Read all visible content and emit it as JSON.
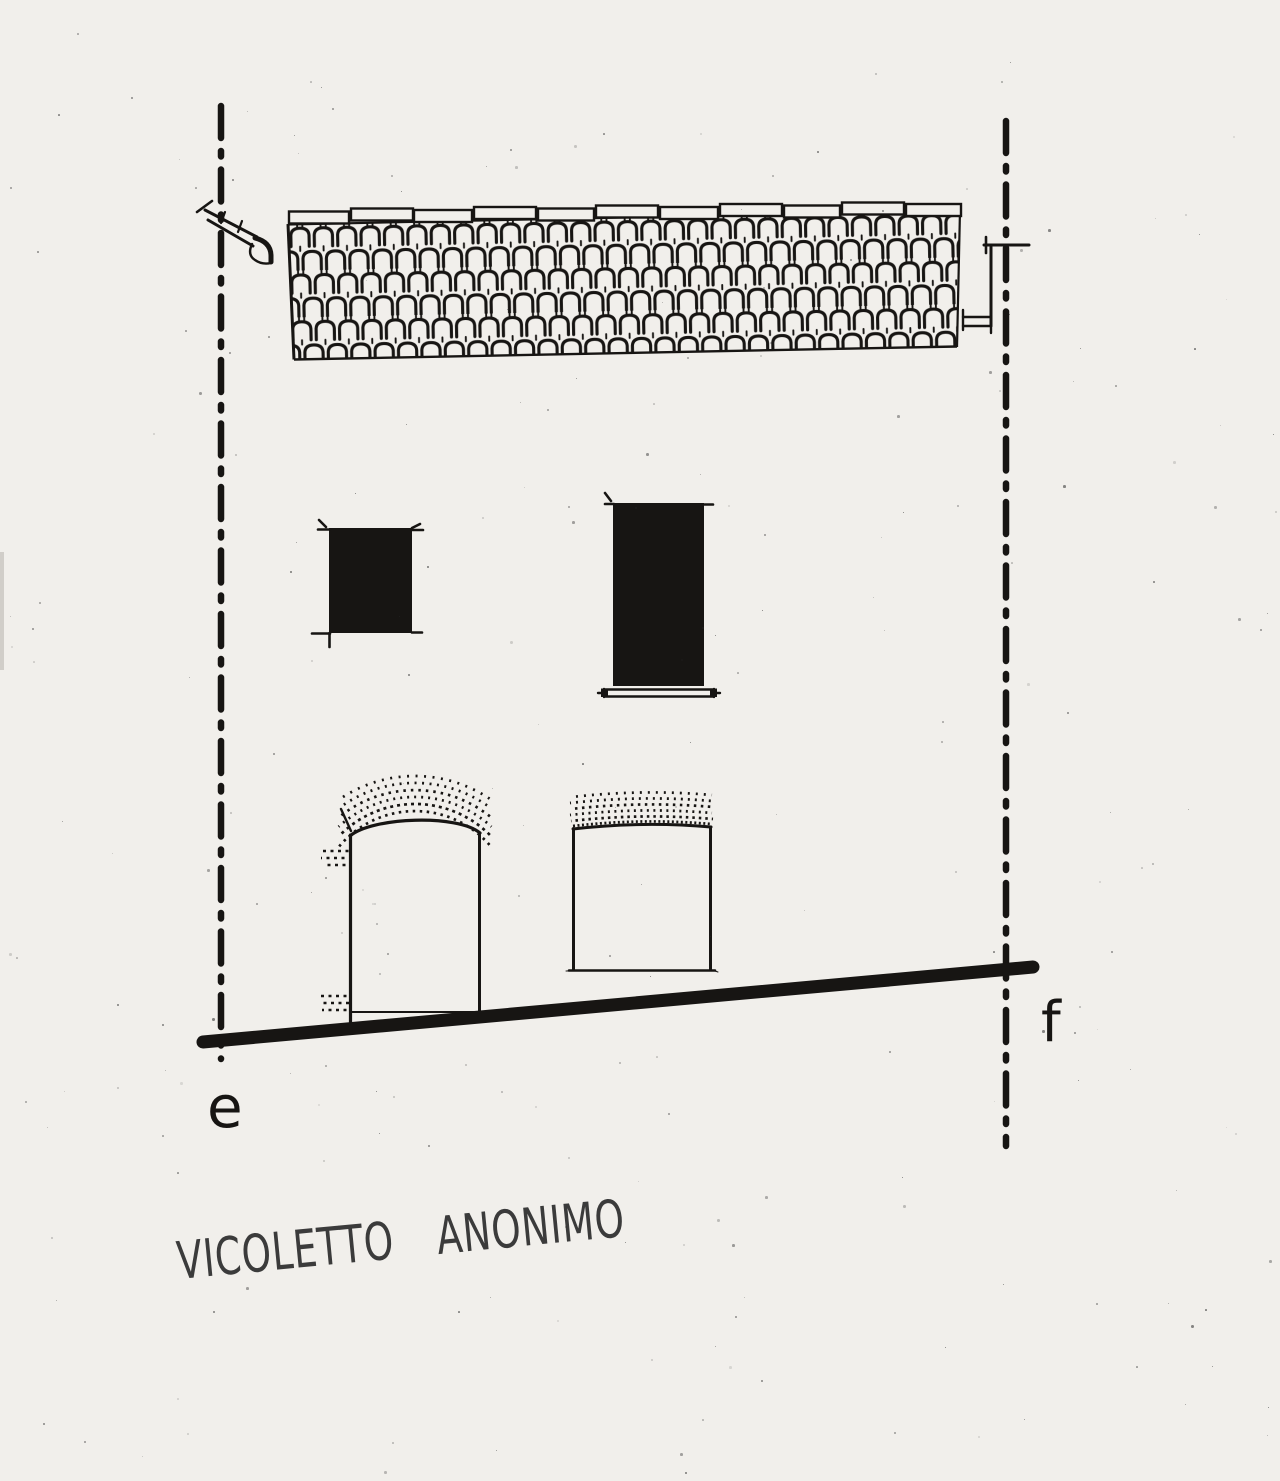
{
  "drawing": {
    "caption": "VICOLETTO ANONIMO",
    "section_markers": {
      "left": "e",
      "right": "f"
    },
    "colors": {
      "paper": "#f1efeb",
      "ink": "#171513",
      "pencil": "#3b3b3b"
    }
  }
}
